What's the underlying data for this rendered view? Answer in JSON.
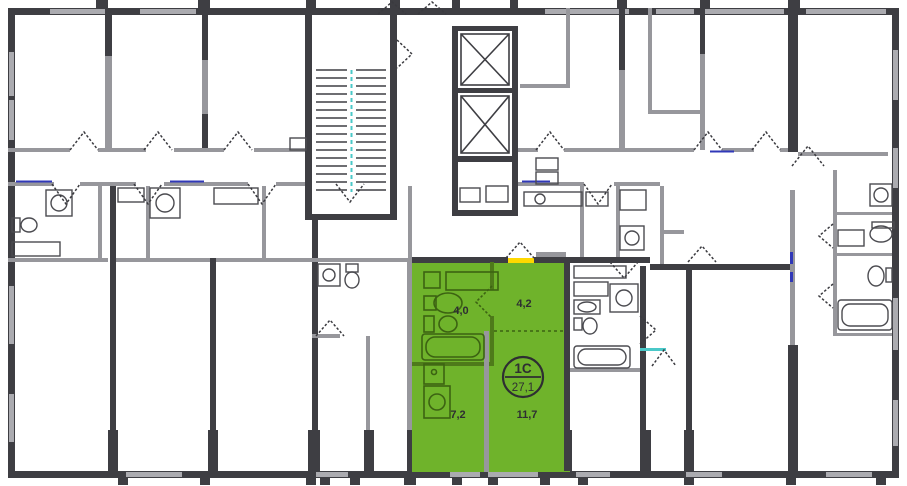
{
  "floor_plan": {
    "selected_apartment": {
      "badge": {
        "type_label": "1С",
        "total_area_label": "27,1"
      },
      "rooms": [
        {
          "name": "bathroom",
          "area_label": "4,0"
        },
        {
          "name": "hallway",
          "area_label": "4,2"
        },
        {
          "name": "kitchen",
          "area_label": "7,2"
        },
        {
          "name": "living-room",
          "area_label": "11,7"
        }
      ],
      "highlight_color": "#6FB32B",
      "outline_color": "#3C6312",
      "entrance_marker_color": "#FFD800"
    },
    "palette": {
      "background": "#FFFFFF",
      "wall_dark": "#3E3E43",
      "wall_light": "#97979C",
      "window_glass": "#ABABB0",
      "fixture_stroke": "#4B4B50",
      "accent_blue": "#3038B8",
      "accent_teal": "#4AC8C8",
      "label_color": "#2E2E32"
    },
    "icons": [
      "staircase-icon",
      "elevator-icon",
      "bathtub-icon",
      "sink-icon",
      "toilet-icon",
      "washing-machine-icon",
      "stove-icon",
      "door-swing-icon",
      "entrance-door-icon"
    ]
  }
}
